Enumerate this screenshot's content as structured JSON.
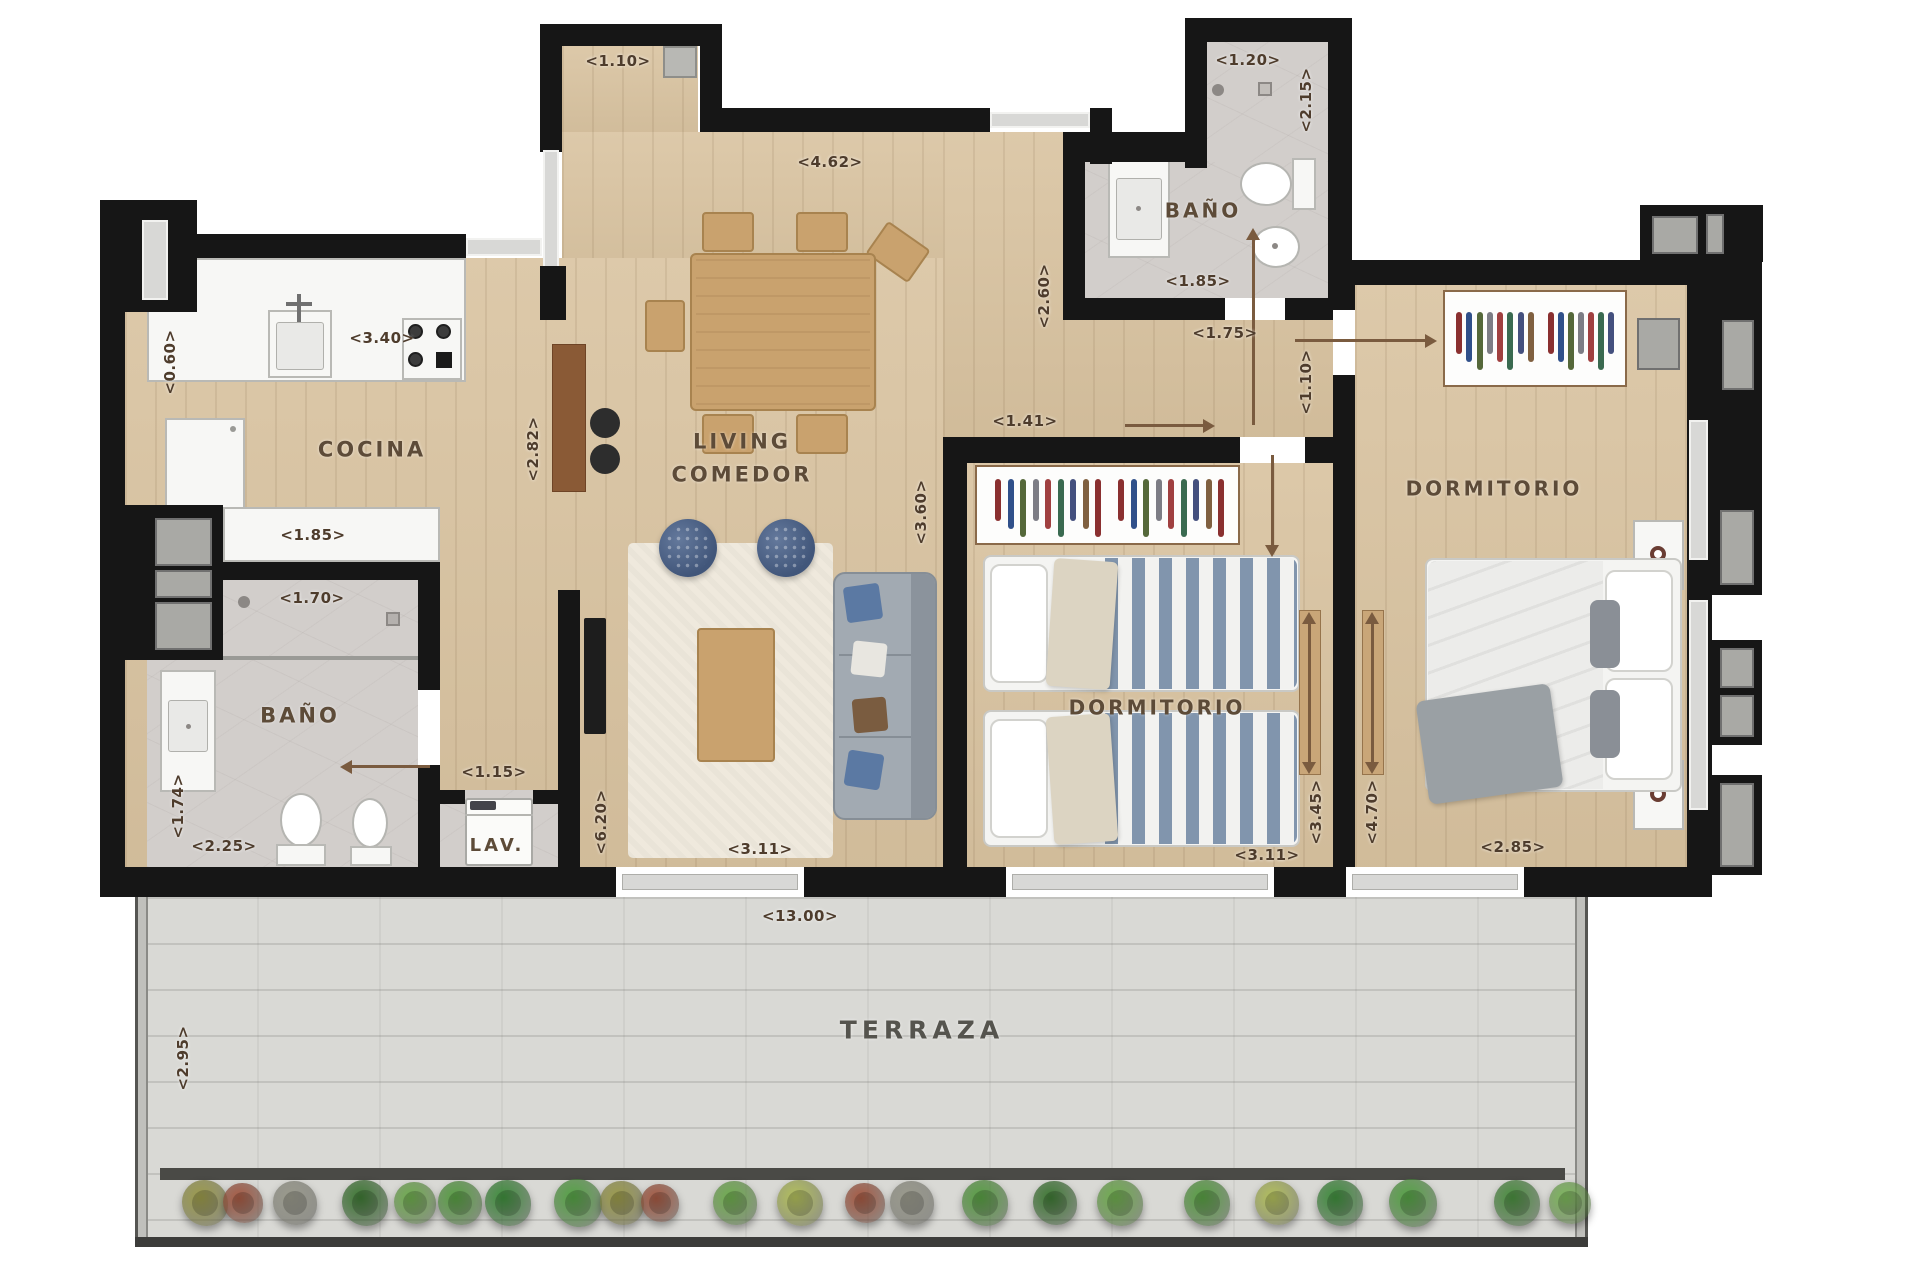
{
  "plan_title": "apartment floor plan",
  "colors": {
    "wall": "#161616",
    "wood_floor": "#d9c3a0",
    "tile_floor": "#d2cecb",
    "terrace_floor": "#d9d9d5",
    "label_text": "#4e3c2c",
    "room_text": "#5d4b38",
    "arrow": "#7a5b3f",
    "window": "#d8d8d6"
  },
  "plan": {
    "room_labels": [
      {
        "id": "cocina",
        "lines": [
          "COCINA"
        ],
        "x": 372,
        "y": 450,
        "size": 21
      },
      {
        "id": "living-comedor",
        "lines": [
          "LIVING",
          "COMEDOR"
        ],
        "x": 742,
        "y": 458,
        "size": 21
      },
      {
        "id": "bano-left",
        "lines": [
          "BAÑO"
        ],
        "x": 300,
        "y": 716,
        "size": 21
      },
      {
        "id": "bano-top",
        "lines": [
          "BAÑO"
        ],
        "x": 1203,
        "y": 211,
        "size": 20
      },
      {
        "id": "dormitorio-middle",
        "lines": [
          "DORMITORIO"
        ],
        "x": 1157,
        "y": 708,
        "size": 20
      },
      {
        "id": "dormitorio-right",
        "lines": [
          "DORMITORIO"
        ],
        "x": 1494,
        "y": 489,
        "size": 20
      },
      {
        "id": "lavadero",
        "lines": [
          "LAV."
        ],
        "x": 497,
        "y": 846,
        "size": 18
      },
      {
        "id": "terraza",
        "lines": [
          "TERRAZA"
        ],
        "x": 922,
        "y": 1031,
        "size": 25
      }
    ],
    "dimension_labels": [
      {
        "text": "<1.10>",
        "x": 618,
        "y": 61,
        "rot": 0
      },
      {
        "text": "<4.62>",
        "x": 830,
        "y": 162,
        "rot": 0
      },
      {
        "text": "<3.40>",
        "x": 382,
        "y": 338,
        "rot": 0
      },
      {
        "text": "<0.60>",
        "x": 170,
        "y": 362,
        "rot": 90
      },
      {
        "text": "<1.85>",
        "x": 313,
        "y": 535,
        "rot": 0
      },
      {
        "text": "<1.70>",
        "x": 312,
        "y": 598,
        "rot": 0
      },
      {
        "text": "<2.82>",
        "x": 533,
        "y": 449,
        "rot": 90
      },
      {
        "text": "<1.74>",
        "x": 178,
        "y": 806,
        "rot": 90
      },
      {
        "text": "<2.25>",
        "x": 224,
        "y": 846,
        "rot": 0
      },
      {
        "text": "<1.15>",
        "x": 494,
        "y": 772,
        "rot": 0
      },
      {
        "text": "<6.20>",
        "x": 601,
        "y": 822,
        "rot": 90
      },
      {
        "text": "<3.11>",
        "x": 760,
        "y": 849,
        "rot": 0
      },
      {
        "text": "<13.00>",
        "x": 800,
        "y": 916,
        "rot": 0
      },
      {
        "text": "<2.95>",
        "x": 183,
        "y": 1058,
        "rot": 90
      },
      {
        "text": "<1.20>",
        "x": 1248,
        "y": 60,
        "rot": 0
      },
      {
        "text": "<2.15>",
        "x": 1306,
        "y": 100,
        "rot": 90
      },
      {
        "text": "<1.85>",
        "x": 1198,
        "y": 281,
        "rot": 0
      },
      {
        "text": "<2.60>",
        "x": 1044,
        "y": 296,
        "rot": 90
      },
      {
        "text": "<1.75>",
        "x": 1225,
        "y": 333,
        "rot": 0
      },
      {
        "text": "<1.41>",
        "x": 1025,
        "y": 421,
        "rot": 0
      },
      {
        "text": "<1.10>",
        "x": 1306,
        "y": 382,
        "rot": 90
      },
      {
        "text": "<3.60>",
        "x": 921,
        "y": 512,
        "rot": 90
      },
      {
        "text": "<3.11>",
        "x": 1267,
        "y": 855,
        "rot": 0
      },
      {
        "text": "<3.45>",
        "x": 1316,
        "y": 812,
        "rot": 90
      },
      {
        "text": "<4.70>",
        "x": 1372,
        "y": 812,
        "rot": 90
      },
      {
        "text": "<2.85>",
        "x": 1513,
        "y": 847,
        "rot": 0
      }
    ],
    "plants": [
      {
        "x": 205,
        "color": "#9c9b4a",
        "r": 46
      },
      {
        "x": 243,
        "color": "#a85a43",
        "r": 40
      },
      {
        "x": 295,
        "color": "#9a9a8c",
        "r": 44
      },
      {
        "x": 365,
        "color": "#3e7a34",
        "r": 46
      },
      {
        "x": 415,
        "color": "#6fae4e",
        "r": 42
      },
      {
        "x": 460,
        "color": "#58a043",
        "r": 44
      },
      {
        "x": 508,
        "color": "#3f8f3d",
        "r": 46
      },
      {
        "x": 578,
        "color": "#55a345",
        "r": 48
      },
      {
        "x": 622,
        "color": "#9c9b4a",
        "r": 44
      },
      {
        "x": 660,
        "color": "#a85a43",
        "r": 38
      },
      {
        "x": 735,
        "color": "#6fae4e",
        "r": 44
      },
      {
        "x": 800,
        "color": "#b3c05b",
        "r": 46
      },
      {
        "x": 865,
        "color": "#a85a43",
        "r": 40
      },
      {
        "x": 912,
        "color": "#9a9a8c",
        "r": 44
      },
      {
        "x": 985,
        "color": "#58a043",
        "r": 46
      },
      {
        "x": 1055,
        "color": "#3e7a34",
        "r": 44
      },
      {
        "x": 1120,
        "color": "#6fae4e",
        "r": 46
      },
      {
        "x": 1207,
        "color": "#58a043",
        "r": 46
      },
      {
        "x": 1277,
        "color": "#b3c05b",
        "r": 44
      },
      {
        "x": 1340,
        "color": "#3f8f3d",
        "r": 46
      },
      {
        "x": 1413,
        "color": "#55a345",
        "r": 48
      },
      {
        "x": 1517,
        "color": "#4a8f3f",
        "r": 46
      },
      {
        "x": 1570,
        "color": "#7cb85a",
        "r": 42
      }
    ],
    "hanger_colors": [
      "#8a3030",
      "#30508a",
      "#55683a",
      "#7d7d85",
      "#a04040",
      "#3a6a50",
      "#44507e",
      "#806040"
    ]
  }
}
